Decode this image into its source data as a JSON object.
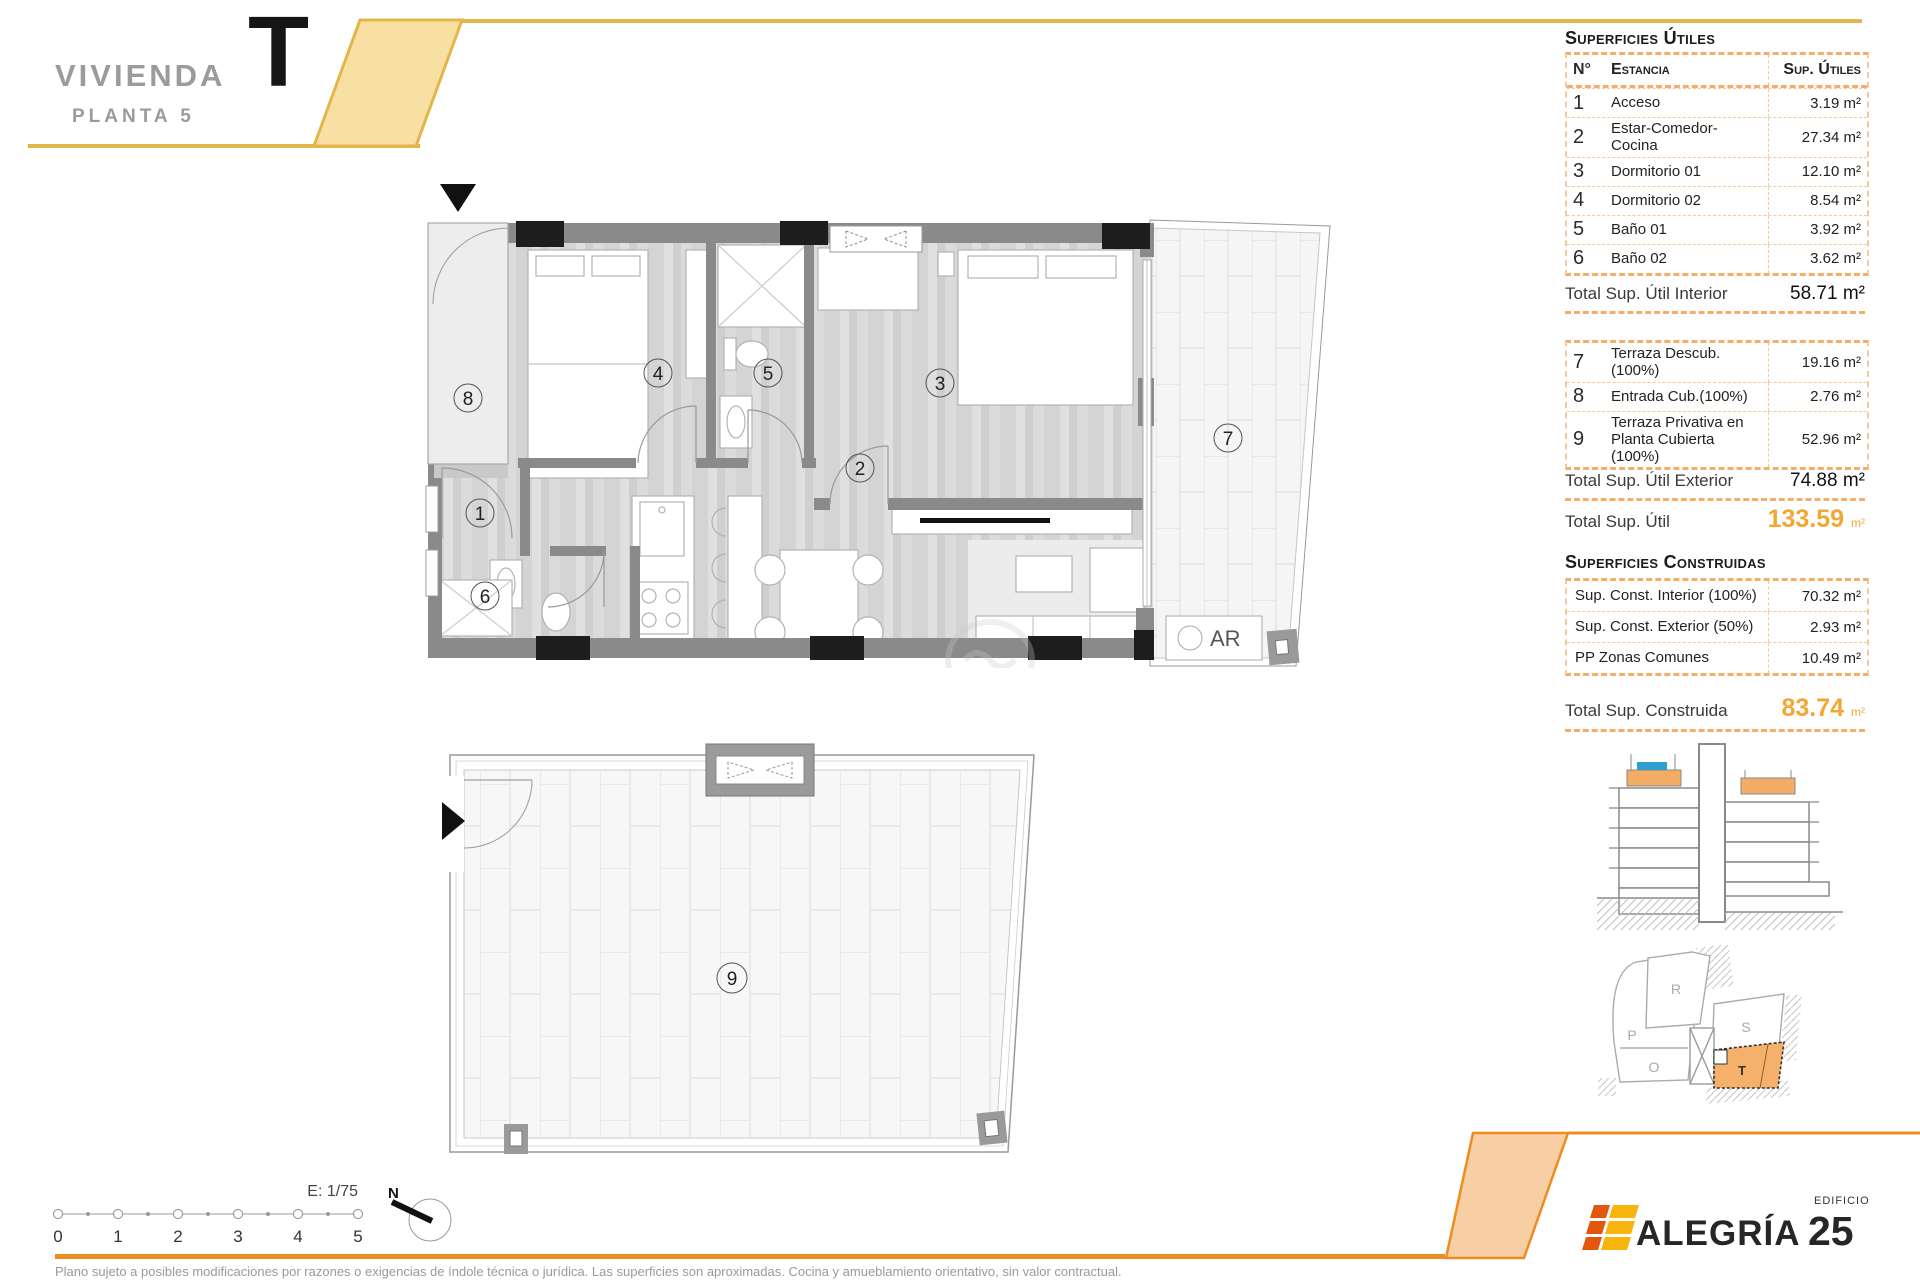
{
  "header": {
    "title": "VIVIENDA",
    "subtitle": "PLANTA 5",
    "unit_letter": "T"
  },
  "surfaces_utiles": {
    "title": "Superficies Útiles",
    "columns": {
      "num": "N°",
      "name": "Estancia",
      "value": "Sup. Útiles"
    },
    "rows": [
      {
        "num": "1",
        "name": "Acceso",
        "value": "3.19 m²"
      },
      {
        "num": "2",
        "name": "Estar-Comedor-Cocina",
        "value": "27.34 m²"
      },
      {
        "num": "3",
        "name": "Dormitorio 01",
        "value": "12.10 m²"
      },
      {
        "num": "4",
        "name": "Dormitorio 02",
        "value": "8.54 m²"
      },
      {
        "num": "5",
        "name": "Baño 01",
        "value": "3.92 m²"
      },
      {
        "num": "6",
        "name": "Baño 02",
        "value": "3.62 m²"
      }
    ],
    "total_interior": {
      "label": "Total Sup. Útil Interior",
      "value": "58.71 m²"
    },
    "exterior_rows": [
      {
        "num": "7",
        "name": "Terraza Descub.(100%)",
        "value": "19.16 m²"
      },
      {
        "num": "8",
        "name": "Entrada Cub.(100%)",
        "value": "2.76 m²"
      },
      {
        "num": "9",
        "name": "Terraza Privativa en Planta Cubierta (100%)",
        "value": "52.96 m²"
      }
    ],
    "total_exterior": {
      "label": "Total Sup. Útil Exterior",
      "value": "74.88 m²"
    },
    "total": {
      "label": "Total Sup. Útil",
      "value": "133.59",
      "unit": "m²"
    }
  },
  "surfaces_construidas": {
    "title": "Superficies Construidas",
    "rows": [
      {
        "name": "Sup. Const. Interior (100%)",
        "value": "70.32 m²"
      },
      {
        "name": "Sup. Const. Exterior (50%)",
        "value": "2.93 m²"
      },
      {
        "name": "PP Zonas Comunes",
        "value": "10.49 m²"
      }
    ],
    "total": {
      "label": "Total Sup. Construida",
      "value": "83.74",
      "unit": "m²"
    }
  },
  "floor_plan": {
    "room_labels": {
      "r1": "1",
      "r2": "2",
      "r3": "3",
      "r4": "4",
      "r5": "5",
      "r6": "6",
      "r7": "7",
      "r8": "8",
      "r9": "9"
    },
    "ar_label": "AR"
  },
  "site_plan": {
    "letters": {
      "p": "P",
      "r": "R",
      "o": "O",
      "s": "S",
      "t": "T"
    }
  },
  "scale_bar": {
    "scale_label": "E: 1/75",
    "ticks": [
      "0",
      "1",
      "2",
      "3",
      "4",
      "5"
    ],
    "north_label": "N"
  },
  "footer": {
    "disclaimer": "Plano sujeto a posibles modificaciones por razones o exigencias de índole técnica o jurídica. Las superficies son aproximadas. Cocina y amueblamiento orientativo, sin valor contractual."
  },
  "logo": {
    "brand": "ALEGRÍA",
    "building_word": "EDIFICIO",
    "building_number": "25"
  },
  "colors": {
    "accent_yellow": "#E3B64B",
    "accent_yellow_fill": "#F8E0A2",
    "accent_orange": "#EF8C1F",
    "accent_orange_fill": "#F8CEA4",
    "table_dash": "#F3AE6A",
    "total_orange": "#F2A735",
    "wall_gray": "#8A8A8A",
    "highlight_unit": "#F5B06B",
    "section_blue": "#2E9FD0"
  }
}
